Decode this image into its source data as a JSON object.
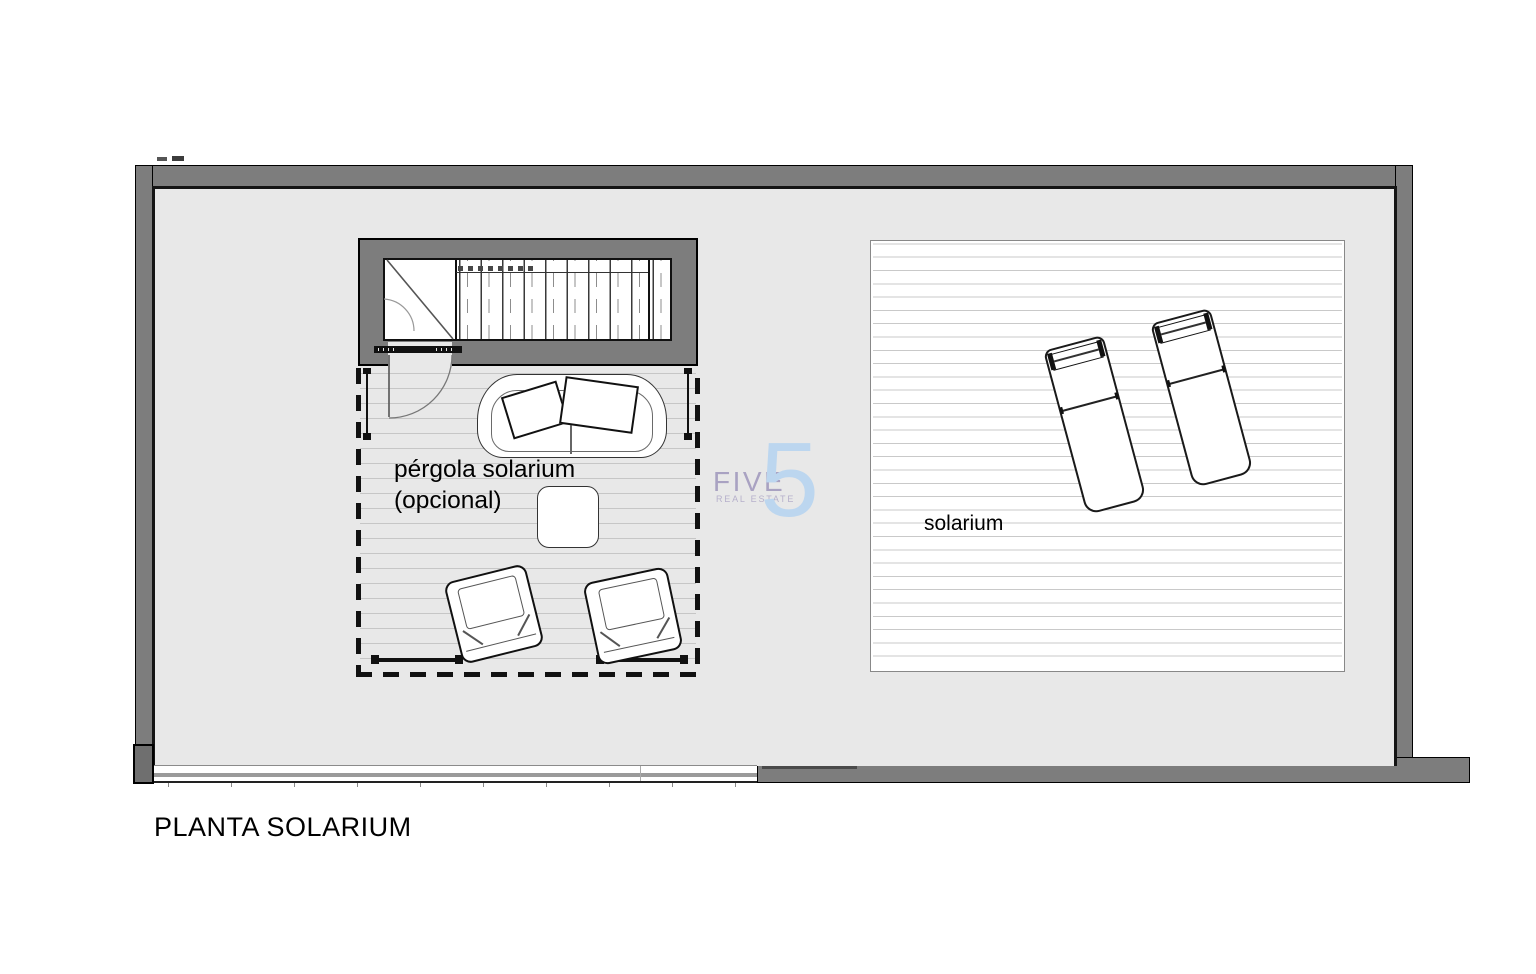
{
  "plan": {
    "title": "PLANTA SOLARIUM",
    "labels": {
      "pergola_line1": "pérgola solarium",
      "pergola_line2": "(opcional)",
      "solarium": "solarium"
    },
    "watermark": {
      "word": "FIVE",
      "tagline": "REAL ESTATE",
      "numeral": "5",
      "word_color": "#a9a2c2",
      "numeral_color": "#bcd6ef"
    },
    "colors": {
      "wall_gray": "#7d7d7d",
      "floor_gray": "#e8e8e8",
      "deck_line_gray": "#c9c9c9",
      "pergola_line_gray": "#c6c6c6",
      "outline_black": "#111111",
      "railing_gray": "#9a9a9a"
    }
  }
}
